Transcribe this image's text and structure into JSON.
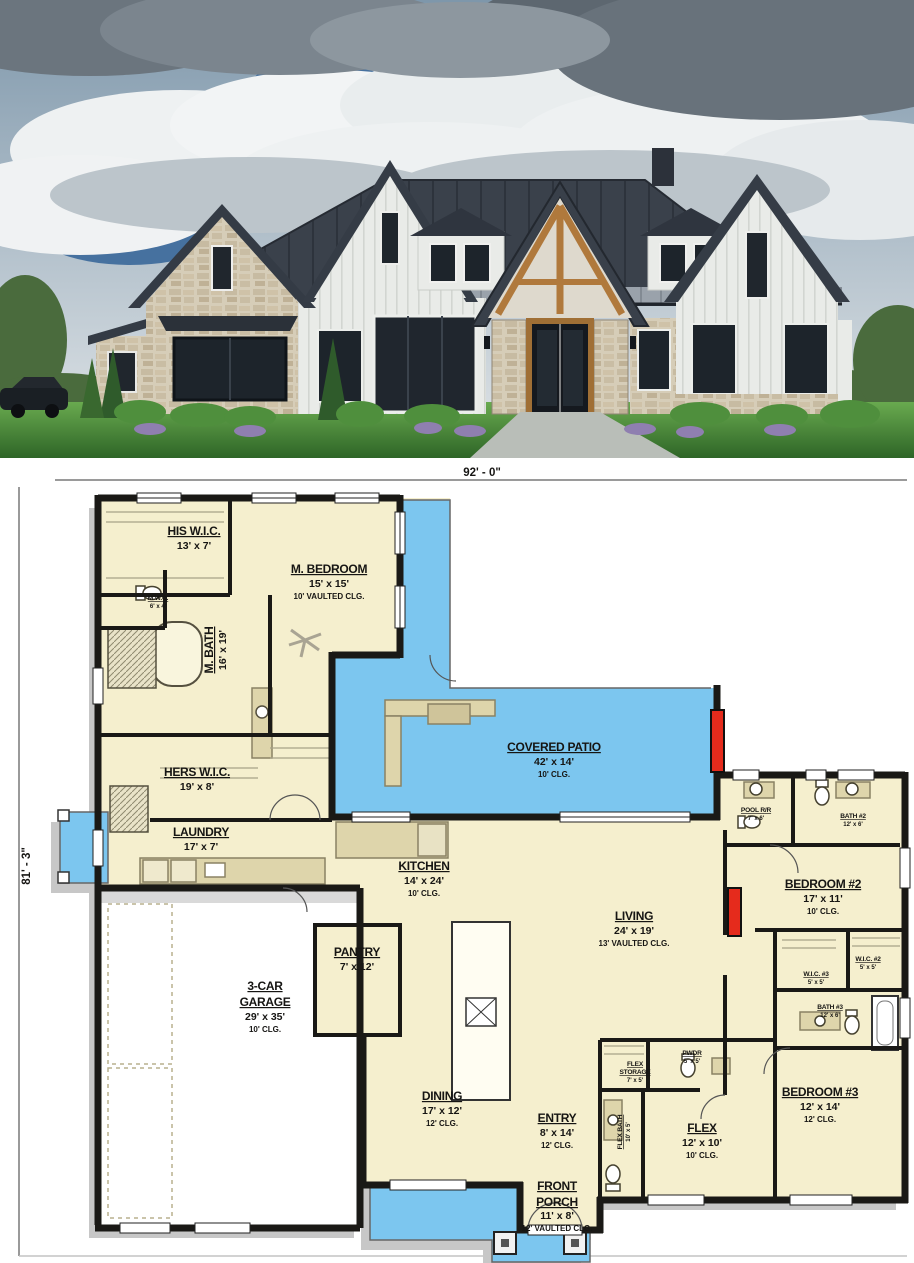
{
  "photo": {
    "subject": "modern-farmhouse-exterior",
    "palette": {
      "roof": "#3a414b",
      "siding": "#e9ebe8",
      "stone": "#d6cdb8",
      "timber": "#b0793c",
      "grass": "#4c9440",
      "sky": "#8ba3b6"
    }
  },
  "plan": {
    "overall_width": "92' - 0\"",
    "overall_depth": "81' - 3\"",
    "colors": {
      "floor": "#f5efce",
      "outdoor": "#7cc6ef",
      "wall": "#1a1916",
      "shadow": "#c7c7c7",
      "counter": "#ded5ab",
      "fireplace": "#e52b1c"
    },
    "rooms": [
      {
        "id": "his-wic",
        "name": "HIS W.I.C.",
        "dims": "13' x 7'"
      },
      {
        "id": "m-bedroom",
        "name": "M. BEDROOM",
        "dims": "15' x 15'",
        "clg": "10' VAULTED CLG."
      },
      {
        "id": "mwc",
        "name": "M.W.C.",
        "dims": "6' x 4'"
      },
      {
        "id": "m-bath",
        "name": "M. BATH",
        "dims": "16' x 19'"
      },
      {
        "id": "hers-wic",
        "name": "HERS W.I.C.",
        "dims": "19' x 8'"
      },
      {
        "id": "laundry",
        "name": "LAUNDRY",
        "dims": "17' x 7'"
      },
      {
        "id": "covered-patio",
        "name": "COVERED PATIO",
        "dims": "42' x 14'",
        "clg": "10' CLG."
      },
      {
        "id": "kitchen",
        "name": "KITCHEN",
        "dims": "14' x 24'",
        "clg": "10' CLG."
      },
      {
        "id": "living",
        "name": "LIVING",
        "dims": "24' x 19'",
        "clg": "13' VAULTED CLG."
      },
      {
        "id": "pantry",
        "name": "PANTRY",
        "dims": "7' x 12'"
      },
      {
        "id": "garage",
        "name": "3-CAR",
        "name2": "GARAGE",
        "dims": "29' x 35'",
        "clg": "10' CLG."
      },
      {
        "id": "dining",
        "name": "DINING",
        "dims": "17' x 12'",
        "clg": "12' CLG."
      },
      {
        "id": "entry",
        "name": "ENTRY",
        "dims": "8' x 14'",
        "clg": "12' CLG."
      },
      {
        "id": "front-porch",
        "name": "FRONT",
        "name2": "PORCH",
        "dims": "11' x 8'",
        "clg": "12' VAULTED CLG."
      },
      {
        "id": "flex",
        "name": "FLEX",
        "dims": "12' x 10'",
        "clg": "10' CLG."
      },
      {
        "id": "flex-storage",
        "name": "FLEX",
        "name2": "STORAGE",
        "dims": "7' x 5'"
      },
      {
        "id": "pwdr",
        "name": "PWDR",
        "dims": "5' x 5'"
      },
      {
        "id": "flex-bath",
        "name": "FLEX BATH",
        "dims": "10' x 5'"
      },
      {
        "id": "pool-rr",
        "name": "POOL R/R",
        "dims": "7' x 6'"
      },
      {
        "id": "bath-2",
        "name": "BATH #2",
        "dims": "12' x 6'"
      },
      {
        "id": "bedroom-2",
        "name": "BEDROOM #2",
        "dims": "17' x 11'",
        "clg": "10' CLG."
      },
      {
        "id": "wic-2",
        "name": "W.I.C. #2",
        "dims": "5' x 5'"
      },
      {
        "id": "wic-3",
        "name": "W.I.C. #3",
        "dims": "5' x 5'"
      },
      {
        "id": "bath-3",
        "name": "BATH #3",
        "dims": "12' x 6'"
      },
      {
        "id": "bedroom-3",
        "name": "BEDROOM #3",
        "dims": "12' x 14'",
        "clg": "12' CLG."
      }
    ]
  }
}
